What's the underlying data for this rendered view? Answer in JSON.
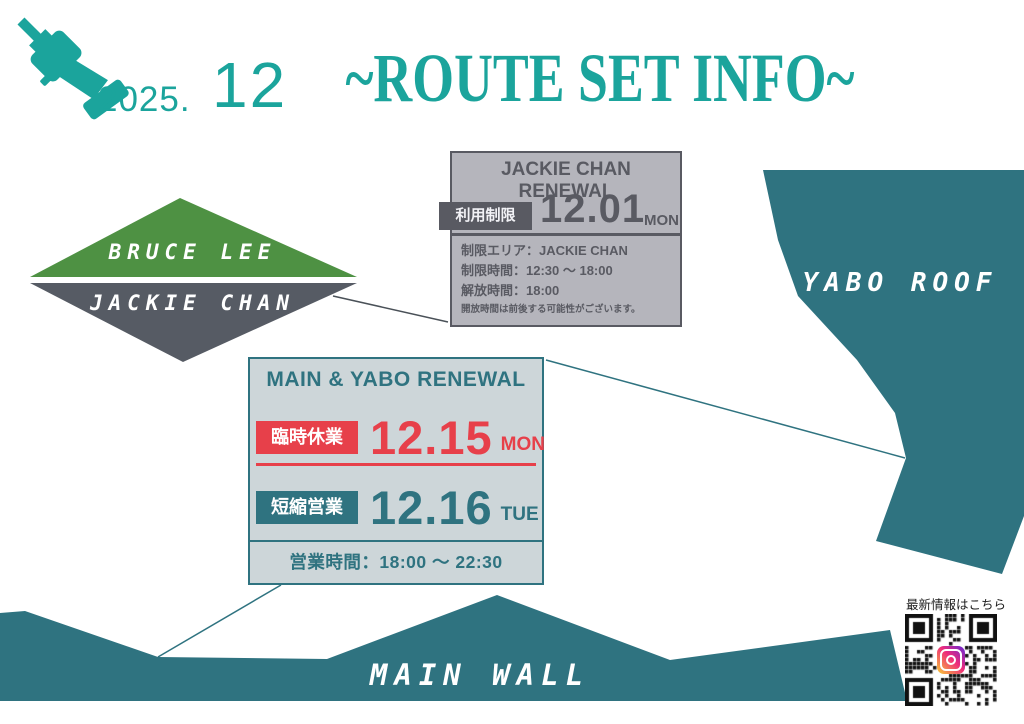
{
  "header": {
    "year": "2025.",
    "month": "12",
    "title": "~ROUTE SET INFO~",
    "drill_icon": "drill-driver-icon"
  },
  "jackie_box": {
    "heading": "JACKIE CHAN RENEWAL",
    "badge": "利用制限",
    "date": "12.01",
    "day": "MON",
    "details": [
      "制限エリア：JACKIE CHAN",
      "制限時間：12:30 〜 18:00",
      "解放時間：18:00"
    ],
    "note": "開放時間は前後する可能性がございます。"
  },
  "diamond": {
    "top_label": "BRUCE LEE",
    "bottom_label": "JACKIE CHAN"
  },
  "yabo": {
    "label": "YABO ROOF"
  },
  "main_yabo_box": {
    "heading": "MAIN & YABO RENEWAL",
    "rows": [
      {
        "badge": "臨時休業",
        "date": "12.15",
        "day": "MON"
      },
      {
        "badge": "短縮営業",
        "date": "12.16",
        "day": "TUE"
      }
    ],
    "hours": "営業時間：18:00 〜 22:30"
  },
  "main_wall": {
    "label": "MAIN WALL"
  },
  "qr": {
    "label": "最新情報はこちら",
    "icon": "instagram-icon"
  },
  "colors": {
    "accent_teal": "#1ba49c",
    "shape_teal": "#2f7380",
    "diamond_green": "#4e9143",
    "diamond_gray": "#565b64",
    "gray_card_bg": "#b5b5bc",
    "gray_card_ink": "#595a62",
    "blue_card_bg": "#cdd6d9",
    "alert_red": "#e7404a"
  }
}
